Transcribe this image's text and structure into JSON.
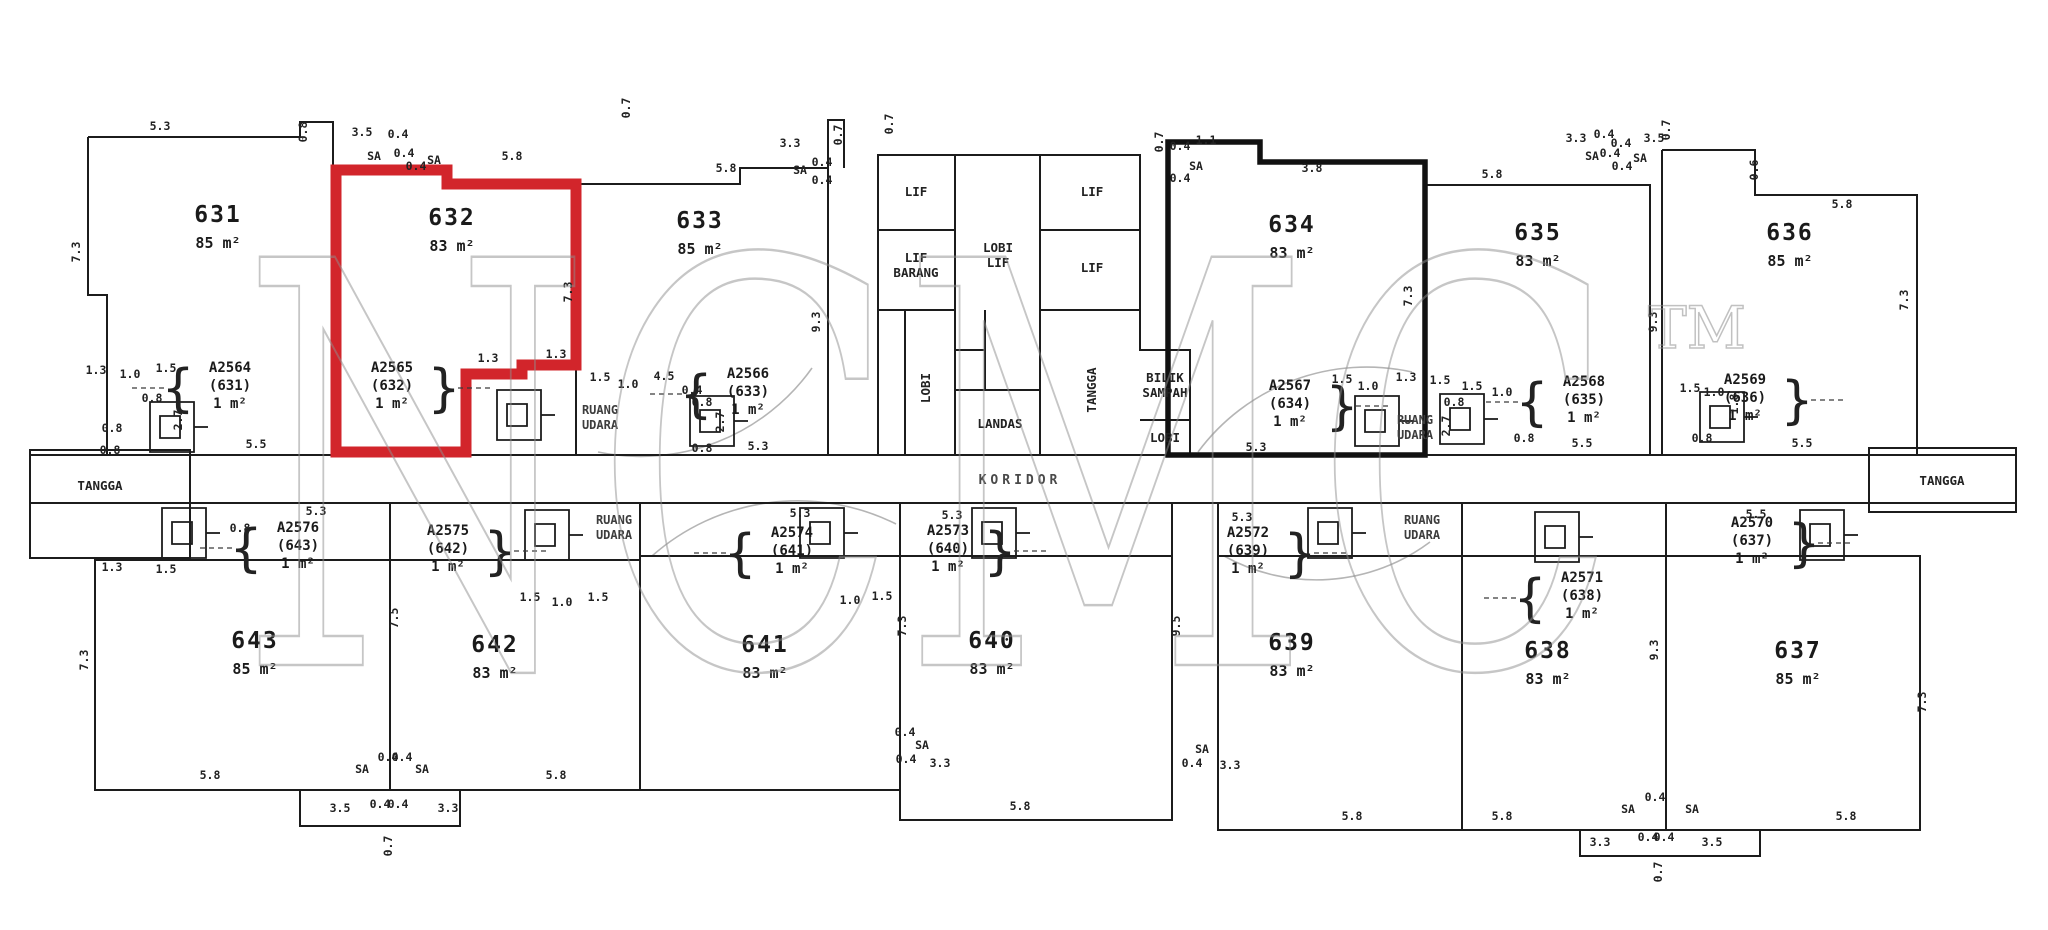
{
  "watermark": {
    "text": "NCMC",
    "tm": "TM"
  },
  "highlight": {
    "unit": "632",
    "color": "#d2252b"
  },
  "corridor": {
    "label": "KORIDOR"
  },
  "stairs": {
    "left": "TANGGA",
    "right": "TANGGA"
  },
  "units_top": [
    {
      "no": "631",
      "area": "85 m²",
      "cx": 218,
      "cy": 222
    },
    {
      "no": "632",
      "area": "83 m²",
      "cx": 452,
      "cy": 225
    },
    {
      "no": "633",
      "area": "85 m²",
      "cx": 700,
      "cy": 228
    },
    {
      "no": "634",
      "area": "83 m²",
      "cx": 1292,
      "cy": 232
    },
    {
      "no": "635",
      "area": "83 m²",
      "cx": 1538,
      "cy": 240
    },
    {
      "no": "636",
      "area": "85 m²",
      "cx": 1790,
      "cy": 240
    }
  ],
  "units_bottom": [
    {
      "no": "643",
      "area": "85 m²",
      "cx": 255,
      "cy": 648
    },
    {
      "no": "642",
      "area": "83 m²",
      "cx": 495,
      "cy": 652
    },
    {
      "no": "641",
      "area": "83 m²",
      "cx": 765,
      "cy": 652
    },
    {
      "no": "640",
      "area": "83 m²",
      "cx": 992,
      "cy": 648
    },
    {
      "no": "639",
      "area": "83 m²",
      "cx": 1292,
      "cy": 650
    },
    {
      "no": "638",
      "area": "83 m²",
      "cx": 1548,
      "cy": 658
    },
    {
      "no": "637",
      "area": "85 m²",
      "cx": 1798,
      "cy": 658
    }
  ],
  "core_rooms": [
    {
      "lines": [
        "LIF"
      ],
      "cx": 916,
      "cy": 196,
      "rot": 0
    },
    {
      "lines": [
        "LIF"
      ],
      "cx": 1092,
      "cy": 196,
      "rot": 0
    },
    {
      "lines": [
        "LIF",
        "BARANG"
      ],
      "cx": 916,
      "cy": 262,
      "rot": 0
    },
    {
      "lines": [
        "LOBI",
        "LIF"
      ],
      "cx": 998,
      "cy": 252,
      "rot": 0
    },
    {
      "lines": [
        "LIF"
      ],
      "cx": 1092,
      "cy": 272,
      "rot": 0
    },
    {
      "lines": [
        "LOBI"
      ],
      "cx": 930,
      "cy": 388,
      "rot": -90
    },
    {
      "lines": [
        "LANDAS"
      ],
      "cx": 1000,
      "cy": 428,
      "rot": 0
    },
    {
      "lines": [
        "TANGGA"
      ],
      "cx": 1096,
      "cy": 390,
      "rot": -90
    },
    {
      "lines": [
        "BILIK",
        "SAMPAH"
      ],
      "cx": 1165,
      "cy": 382,
      "rot": 0
    },
    {
      "lines": [
        "LOBI"
      ],
      "cx": 1165,
      "cy": 442,
      "rot": 0
    }
  ],
  "void_labels": [
    {
      "lines": [
        "RUANG",
        "UDARA"
      ],
      "cx": 600,
      "cy": 414
    },
    {
      "lines": [
        "RUANG",
        "UDARA"
      ],
      "cx": 1415,
      "cy": 424
    },
    {
      "lines": [
        "RUANG",
        "UDARA"
      ],
      "cx": 614,
      "cy": 524
    },
    {
      "lines": [
        "RUANG",
        "UDARA"
      ],
      "cx": 1422,
      "cy": 524
    }
  ],
  "parcel_labels": [
    {
      "lines": [
        "A2564",
        "(631)",
        "1 m²"
      ],
      "x": 230,
      "y": 372,
      "brace": "left"
    },
    {
      "lines": [
        "A2565",
        "(632)",
        "1 m²"
      ],
      "x": 392,
      "y": 372,
      "brace": "right"
    },
    {
      "lines": [
        "A2566",
        "(633)",
        "1 m²"
      ],
      "x": 748,
      "y": 378,
      "brace": "left"
    },
    {
      "lines": [
        "A2567",
        "(634)",
        "1 m²"
      ],
      "x": 1290,
      "y": 390,
      "brace": "right"
    },
    {
      "lines": [
        "A2568",
        "(635)",
        "1 m²"
      ],
      "x": 1584,
      "y": 386,
      "brace": "left"
    },
    {
      "lines": [
        "A2569",
        "(636)",
        "1 m²"
      ],
      "x": 1745,
      "y": 384,
      "brace": "right"
    },
    {
      "lines": [
        "A2576",
        "(643)",
        "1 m²"
      ],
      "x": 298,
      "y": 532,
      "brace": "left"
    },
    {
      "lines": [
        "A2575",
        "(642)",
        "1 m²"
      ],
      "x": 448,
      "y": 535,
      "brace": "right"
    },
    {
      "lines": [
        "A2574",
        "(641)",
        "1 m²"
      ],
      "x": 792,
      "y": 537,
      "brace": "left"
    },
    {
      "lines": [
        "A2573",
        "(640)",
        "1 m²"
      ],
      "x": 948,
      "y": 535,
      "brace": "right"
    },
    {
      "lines": [
        "A2572",
        "(639)",
        "1 m²"
      ],
      "x": 1248,
      "y": 537,
      "brace": "right"
    },
    {
      "lines": [
        "A2571",
        "(638)",
        "1 m²"
      ],
      "x": 1582,
      "y": 582,
      "brace": "left"
    },
    {
      "lines": [
        "A2570",
        "(637)",
        "1 m²"
      ],
      "x": 1752,
      "y": 527,
      "brace": "right"
    }
  ],
  "dims": [
    {
      "t": "5.3",
      "x": 160,
      "y": 130,
      "r": 0
    },
    {
      "t": "0.8",
      "x": 307,
      "y": 132,
      "r": 1
    },
    {
      "t": "3.5",
      "x": 362,
      "y": 136,
      "r": 0
    },
    {
      "t": "0.4",
      "x": 398,
      "y": 138,
      "r": 0
    },
    {
      "t": "SA",
      "x": 374,
      "y": 160,
      "r": 0
    },
    {
      "t": "0.4",
      "x": 404,
      "y": 157,
      "r": 0
    },
    {
      "t": "0.4",
      "x": 416,
      "y": 170,
      "r": 0
    },
    {
      "t": "SA",
      "x": 434,
      "y": 164,
      "r": 0
    },
    {
      "t": "5.8",
      "x": 512,
      "y": 160,
      "r": 0
    },
    {
      "t": "0.7",
      "x": 630,
      "y": 108,
      "r": 1
    },
    {
      "t": "5.8",
      "x": 726,
      "y": 172,
      "r": 0
    },
    {
      "t": "3.3",
      "x": 790,
      "y": 147,
      "r": 0
    },
    {
      "t": "SA",
      "x": 800,
      "y": 174,
      "r": 0
    },
    {
      "t": "0.4",
      "x": 822,
      "y": 166,
      "r": 0
    },
    {
      "t": "0.4",
      "x": 822,
      "y": 184,
      "r": 0
    },
    {
      "t": "0.7",
      "x": 842,
      "y": 135,
      "r": 1
    },
    {
      "t": "0.7",
      "x": 893,
      "y": 124,
      "r": 1
    },
    {
      "t": "0.4",
      "x": 1180,
      "y": 150,
      "r": 0
    },
    {
      "t": "1.1",
      "x": 1206,
      "y": 144,
      "r": 0
    },
    {
      "t": "SA",
      "x": 1196,
      "y": 170,
      "r": 0
    },
    {
      "t": "0.4",
      "x": 1180,
      "y": 182,
      "r": 0
    },
    {
      "t": "3.8",
      "x": 1312,
      "y": 172,
      "r": 0
    },
    {
      "t": "5.8",
      "x": 1492,
      "y": 178,
      "r": 0
    },
    {
      "t": "3.3",
      "x": 1576,
      "y": 142,
      "r": 0
    },
    {
      "t": "0.4",
      "x": 1604,
      "y": 138,
      "r": 0
    },
    {
      "t": "0.4",
      "x": 1621,
      "y": 147,
      "r": 0
    },
    {
      "t": "3.5",
      "x": 1654,
      "y": 142,
      "r": 0
    },
    {
      "t": "SA",
      "x": 1592,
      "y": 160,
      "r": 0
    },
    {
      "t": "0.4",
      "x": 1610,
      "y": 157,
      "r": 0
    },
    {
      "t": "SA",
      "x": 1640,
      "y": 162,
      "r": 0
    },
    {
      "t": "0.4",
      "x": 1622,
      "y": 170,
      "r": 0
    },
    {
      "t": "0.7",
      "x": 1670,
      "y": 130,
      "r": 1
    },
    {
      "t": "0.6",
      "x": 1758,
      "y": 170,
      "r": 1
    },
    {
      "t": "5.8",
      "x": 1842,
      "y": 208,
      "r": 0
    },
    {
      "t": "7.3",
      "x": 80,
      "y": 252,
      "r": 1
    },
    {
      "t": "7.3",
      "x": 572,
      "y": 292,
      "r": 1
    },
    {
      "t": "9.3",
      "x": 820,
      "y": 322,
      "r": 1
    },
    {
      "t": "0.7",
      "x": 1163,
      "y": 142,
      "r": 1
    },
    {
      "t": "7.3",
      "x": 1412,
      "y": 296,
      "r": 1
    },
    {
      "t": "9.3",
      "x": 1657,
      "y": 322,
      "r": 1
    },
    {
      "t": "7.3",
      "x": 1908,
      "y": 300,
      "r": 1
    },
    {
      "t": "1.3",
      "x": 96,
      "y": 374,
      "r": 0
    },
    {
      "t": "1.0",
      "x": 130,
      "y": 378,
      "r": 0
    },
    {
      "t": "1.5",
      "x": 166,
      "y": 372,
      "r": 0
    },
    {
      "t": "0.8",
      "x": 152,
      "y": 402,
      "r": 0
    },
    {
      "t": "2.7",
      "x": 182,
      "y": 420,
      "r": 1
    },
    {
      "t": "0.8",
      "x": 112,
      "y": 432,
      "r": 0
    },
    {
      "t": "5.5",
      "x": 256,
      "y": 448,
      "r": 0
    },
    {
      "t": "0.8",
      "x": 110,
      "y": 454,
      "r": 0
    },
    {
      "t": "1.3",
      "x": 488,
      "y": 362,
      "r": 0
    },
    {
      "t": "1.3",
      "x": 556,
      "y": 358,
      "r": 0
    },
    {
      "t": "1.5",
      "x": 600,
      "y": 381,
      "r": 0
    },
    {
      "t": "1.0",
      "x": 628,
      "y": 388,
      "r": 0
    },
    {
      "t": "4.5",
      "x": 664,
      "y": 380,
      "r": 0
    },
    {
      "t": "0.4",
      "x": 692,
      "y": 394,
      "r": 0
    },
    {
      "t": "0.8",
      "x": 702,
      "y": 406,
      "r": 0
    },
    {
      "t": "2.7",
      "x": 724,
      "y": 422,
      "r": 1
    },
    {
      "t": "0.8",
      "x": 702,
      "y": 452,
      "r": 0
    },
    {
      "t": "5.3",
      "x": 758,
      "y": 450,
      "r": 0
    },
    {
      "t": "1.5",
      "x": 1342,
      "y": 383,
      "r": 0
    },
    {
      "t": "1.0",
      "x": 1368,
      "y": 390,
      "r": 0
    },
    {
      "t": "1.3",
      "x": 1406,
      "y": 381,
      "r": 0
    },
    {
      "t": "1.5",
      "x": 1440,
      "y": 384,
      "r": 0
    },
    {
      "t": "0.8",
      "x": 1454,
      "y": 406,
      "r": 0
    },
    {
      "t": "2.7",
      "x": 1450,
      "y": 426,
      "r": 1
    },
    {
      "t": "1.5",
      "x": 1472,
      "y": 390,
      "r": 0
    },
    {
      "t": "1.0",
      "x": 1502,
      "y": 396,
      "r": 0
    },
    {
      "t": "0.8",
      "x": 1524,
      "y": 442,
      "r": 0
    },
    {
      "t": "1.5",
      "x": 1690,
      "y": 392,
      "r": 0
    },
    {
      "t": "1.0",
      "x": 1714,
      "y": 396,
      "r": 0
    },
    {
      "t": "1.8",
      "x": 1738,
      "y": 404,
      "r": 1
    },
    {
      "t": "0.8",
      "x": 1702,
      "y": 442,
      "r": 0
    },
    {
      "t": "5.5",
      "x": 1582,
      "y": 447,
      "r": 0
    },
    {
      "t": "5.5",
      "x": 1802,
      "y": 447,
      "r": 0
    },
    {
      "t": "5.3",
      "x": 1256,
      "y": 451,
      "r": 0
    },
    {
      "t": "5.3",
      "x": 316,
      "y": 515,
      "r": 0
    },
    {
      "t": "5.3",
      "x": 800,
      "y": 517,
      "r": 0
    },
    {
      "t": "5.3",
      "x": 952,
      "y": 519,
      "r": 0
    },
    {
      "t": "5.3",
      "x": 1242,
      "y": 521,
      "r": 0
    },
    {
      "t": "5.5",
      "x": 1756,
      "y": 518,
      "r": 0
    },
    {
      "t": "1.3",
      "x": 112,
      "y": 571,
      "r": 0
    },
    {
      "t": "1.5",
      "x": 166,
      "y": 573,
      "r": 0
    },
    {
      "t": "0.8",
      "x": 240,
      "y": 532,
      "r": 0
    },
    {
      "t": "1.5",
      "x": 530,
      "y": 601,
      "r": 0
    },
    {
      "t": "1.0",
      "x": 562,
      "y": 606,
      "r": 0
    },
    {
      "t": "1.5",
      "x": 598,
      "y": 601,
      "r": 0
    },
    {
      "t": "1.0",
      "x": 850,
      "y": 604,
      "r": 0
    },
    {
      "t": "1.5",
      "x": 882,
      "y": 600,
      "r": 0
    },
    {
      "t": "0.4",
      "x": 905,
      "y": 736,
      "r": 0
    },
    {
      "t": "SA",
      "x": 922,
      "y": 749,
      "r": 0
    },
    {
      "t": "0.4",
      "x": 906,
      "y": 763,
      "r": 0
    },
    {
      "t": "3.3",
      "x": 940,
      "y": 767,
      "r": 0
    },
    {
      "t": "SA",
      "x": 1202,
      "y": 753,
      "r": 0
    },
    {
      "t": "0.4",
      "x": 1192,
      "y": 767,
      "r": 0
    },
    {
      "t": "3.3",
      "x": 1230,
      "y": 769,
      "r": 0
    },
    {
      "t": "5.8",
      "x": 210,
      "y": 779,
      "r": 0
    },
    {
      "t": "SA",
      "x": 362,
      "y": 773,
      "r": 0
    },
    {
      "t": "0.4",
      "x": 388,
      "y": 761,
      "r": 0
    },
    {
      "t": "0.4",
      "x": 402,
      "y": 761,
      "r": 0
    },
    {
      "t": "SA",
      "x": 422,
      "y": 773,
      "r": 0
    },
    {
      "t": "3.5",
      "x": 340,
      "y": 812,
      "r": 0
    },
    {
      "t": "0.4",
      "x": 380,
      "y": 808,
      "r": 0
    },
    {
      "t": "0.4",
      "x": 398,
      "y": 808,
      "r": 0
    },
    {
      "t": "3.3",
      "x": 448,
      "y": 812,
      "r": 0
    },
    {
      "t": "5.8",
      "x": 556,
      "y": 779,
      "r": 0
    },
    {
      "t": "0.7",
      "x": 392,
      "y": 846,
      "r": 1
    },
    {
      "t": "5.8",
      "x": 1020,
      "y": 810,
      "r": 0
    },
    {
      "t": "5.8",
      "x": 1352,
      "y": 820,
      "r": 0
    },
    {
      "t": "5.8",
      "x": 1502,
      "y": 820,
      "r": 0
    },
    {
      "t": "SA",
      "x": 1628,
      "y": 813,
      "r": 0
    },
    {
      "t": "0.4",
      "x": 1655,
      "y": 801,
      "r": 0
    },
    {
      "t": "SA",
      "x": 1692,
      "y": 813,
      "r": 0
    },
    {
      "t": "3.3",
      "x": 1600,
      "y": 846,
      "r": 0
    },
    {
      "t": "0.4",
      "x": 1648,
      "y": 841,
      "r": 0
    },
    {
      "t": "0.4",
      "x": 1664,
      "y": 841,
      "r": 0
    },
    {
      "t": "3.5",
      "x": 1712,
      "y": 846,
      "r": 0
    },
    {
      "t": "5.8",
      "x": 1846,
      "y": 820,
      "r": 0
    },
    {
      "t": "0.7",
      "x": 1662,
      "y": 872,
      "r": 1
    },
    {
      "t": "7.3",
      "x": 88,
      "y": 660,
      "r": 1
    },
    {
      "t": "7.5",
      "x": 398,
      "y": 618,
      "r": 1
    },
    {
      "t": "7.3",
      "x": 906,
      "y": 626,
      "r": 1
    },
    {
      "t": "9.5",
      "x": 1180,
      "y": 626,
      "r": 1
    },
    {
      "t": "9.3",
      "x": 1658,
      "y": 650,
      "r": 1
    },
    {
      "t": "7.3",
      "x": 1926,
      "y": 702,
      "r": 1
    }
  ]
}
